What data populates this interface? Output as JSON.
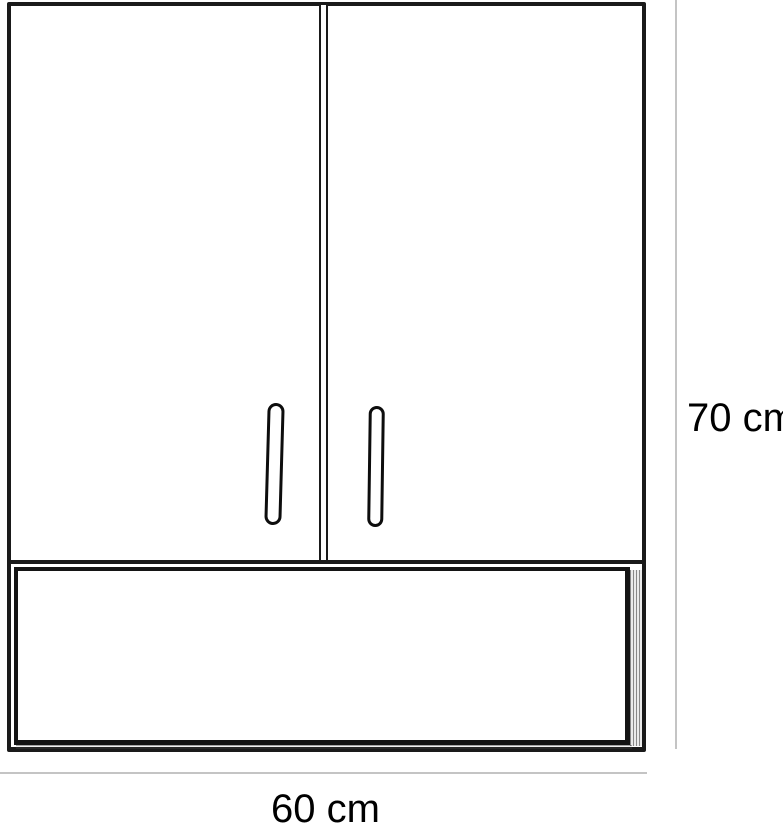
{
  "diagram": {
    "labels": {
      "height": "70 cm",
      "width": "60 cm"
    },
    "colors": {
      "line": "#1a1a1a",
      "dimension_line": "#c4c4c4",
      "background": "#ffffff"
    },
    "components": {
      "doors": 2,
      "handles": 2,
      "open_shelf": 1
    }
  }
}
